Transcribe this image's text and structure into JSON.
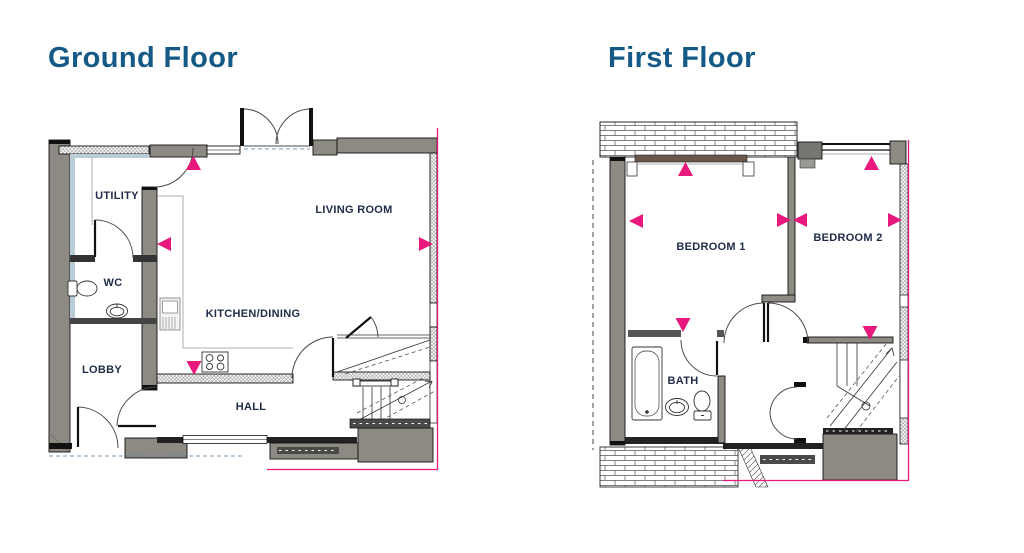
{
  "colors": {
    "title_blue": "#155987",
    "label_navy": "#1f2b47",
    "marker_pink": "#e8187d",
    "wall_gray": "#8d8983",
    "lining_blue": "#b9cdd9"
  },
  "ground_floor": {
    "title": "Ground Floor",
    "rooms": {
      "utility": "UTILITY",
      "wc": "WC",
      "lobby": "LOBBY",
      "kitchen_dining": "KITCHEN/DINING",
      "hall": "HALL",
      "living_room": "LIVING ROOM"
    }
  },
  "first_floor": {
    "title": "First Floor",
    "rooms": {
      "bedroom1": "BEDROOM 1",
      "bedroom2": "BEDROOM 2",
      "bath": "BATH"
    }
  }
}
